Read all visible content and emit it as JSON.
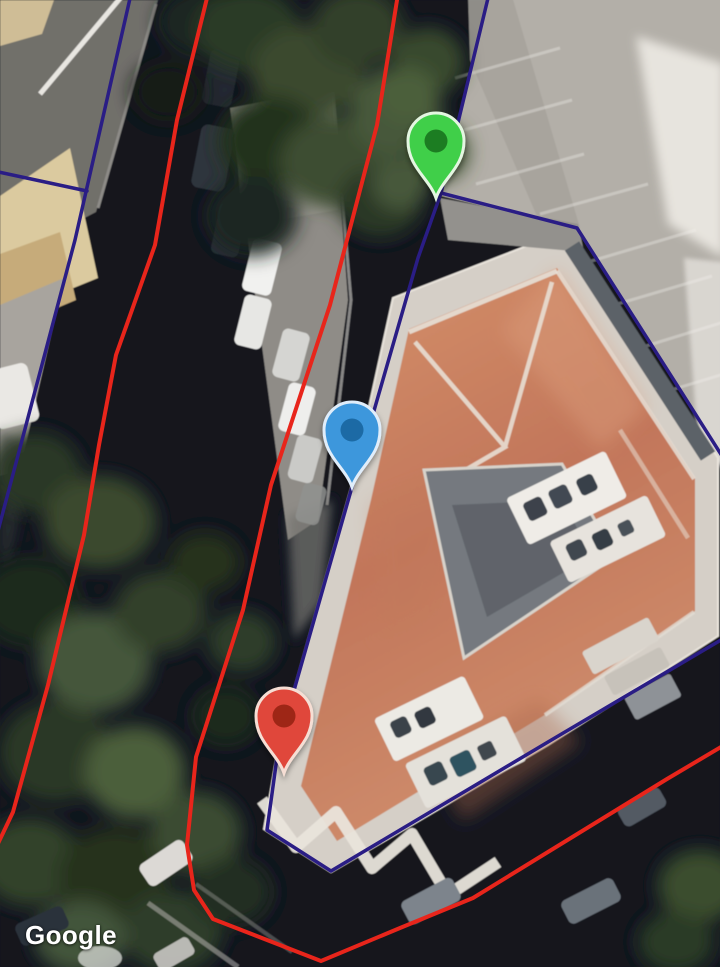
{
  "watermark": {
    "text": "Google"
  },
  "map": {
    "view": "satellite",
    "overlays": {
      "red": {
        "color": "#e8251b",
        "width": 4,
        "paths": [
          [
            [
              208,
              -6
            ],
            [
              177,
              120
            ],
            [
              155,
              245
            ],
            [
              116,
              355
            ],
            [
              99,
              445
            ],
            [
              84,
              535
            ],
            [
              48,
              685
            ],
            [
              13,
              812
            ],
            [
              -6,
              852
            ]
          ],
          [
            [
              398,
              -6
            ],
            [
              377,
              125
            ],
            [
              330,
              305
            ],
            [
              271,
              485
            ],
            [
              243,
              610
            ],
            [
              196,
              757
            ],
            [
              187,
              845
            ],
            [
              194,
              890
            ],
            [
              213,
              919
            ],
            [
              321,
              961
            ],
            [
              400,
              928
            ],
            [
              473,
              898
            ],
            [
              667,
              779
            ],
            [
              726,
              744
            ]
          ]
        ]
      },
      "blue": {
        "color": "#2a1d85",
        "width": 3.5,
        "paths": [
          [
            [
              131,
              -6
            ],
            [
              75,
              240
            ],
            [
              -6,
              546
            ]
          ],
          [
            [
              -6,
              171
            ],
            [
              87,
              191
            ]
          ],
          [
            [
              489,
              -6
            ],
            [
              441,
              193
            ],
            [
              418,
              258
            ],
            [
              352,
              487
            ],
            [
              279,
              743
            ],
            [
              267,
              830
            ],
            [
              331,
              871
            ],
            [
              548,
              742
            ],
            [
              726,
              637
            ]
          ],
          [
            [
              441,
              193
            ],
            [
              577,
              228
            ],
            [
              724,
              459
            ]
          ]
        ]
      }
    },
    "markers": [
      {
        "name": "green-marker",
        "fill": "#3fcf4a",
        "inner": "#1f7d21",
        "outline": "#e4f6e1",
        "tip_x": 436,
        "tip_y": 198
      },
      {
        "name": "blue-marker",
        "fill": "#3e97dc",
        "inner": "#1a6aa5",
        "outline": "#e0edfa",
        "tip_x": 352,
        "tip_y": 487
      },
      {
        "name": "red-marker",
        "fill": "#e0463a",
        "inner": "#9e2517",
        "outline": "#f6ded4",
        "tip_x": 284,
        "tip_y": 773
      }
    ]
  }
}
